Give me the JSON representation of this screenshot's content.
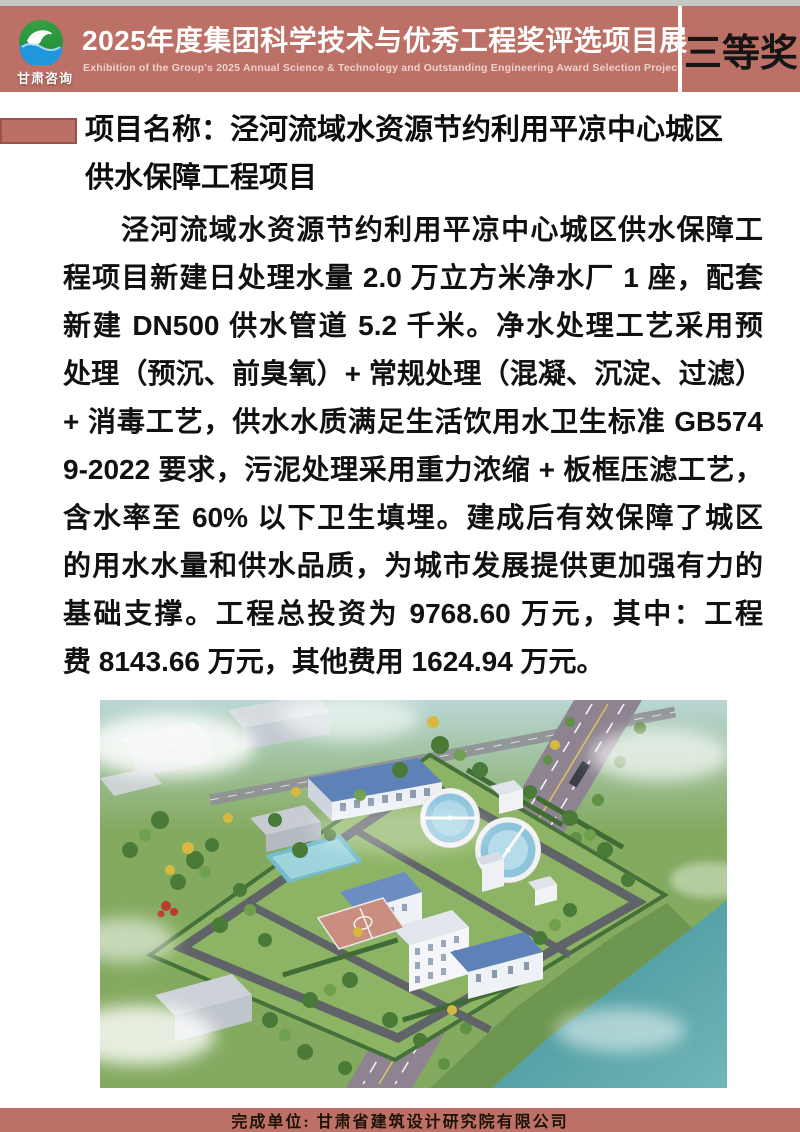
{
  "theme": {
    "top_strip": "#c6c6c6",
    "header_bg": "#bd7066",
    "divider": "#ffffff",
    "title_color": "#ffffff",
    "subtitle_color": "#f2ddd8",
    "award_color": "#151515",
    "bullet_fill": "#bc7065",
    "bullet_border": "#96544a",
    "body_text": "#111111",
    "footer_bg": "#bd7066",
    "footer_text": "#1d1208"
  },
  "header": {
    "logo": {
      "org": "甘肃咨询",
      "icon": "swan-globe-logo"
    },
    "title": "2025年度集团科学技术与优秀工程奖评选项目展",
    "subtitle": "Exhibition of the Group's 2025 Annual Science & Technology and Outstanding Engineering Award Selection Project",
    "award": "三等奖"
  },
  "project": {
    "name_line1": "项目名称：泾河流域水资源节约利用平凉中心城区",
    "name_line2": "供水保障工程项目",
    "description_lines": [
      "泾河流域水资源节约利用平凉中心城区供水保障工",
      "程项目新建日处理水量 2.0 万立方米净水厂 1 座，配套",
      "新建 DN500 供水管道 5.2 千米。净水处理工艺采用预",
      "处理（预沉、前臭氧）+ 常规处理（混凝、沉淀、过滤）",
      "+ 消毒工艺，供水水质满足生活饮用水卫生标准 GB574",
      "9-2022 要求，污泥处理采用重力浓缩 + 板框压滤工艺，",
      "含水率至 60% 以下卫生填埋。建成后有效保障了城区",
      "的用水水量和供水品质，为城市发展提供更加强有力的",
      "基础支撑。工程总投资为 9768.60 万元，其中：工程",
      "费 8143.66 万元，其他费用 1624.94 万元。"
    ]
  },
  "figure": {
    "name": "water-plant-aerial-rendering"
  },
  "footer": {
    "completion_unit": "完成单位: 甘肃省建筑设计研究院有限公司"
  }
}
